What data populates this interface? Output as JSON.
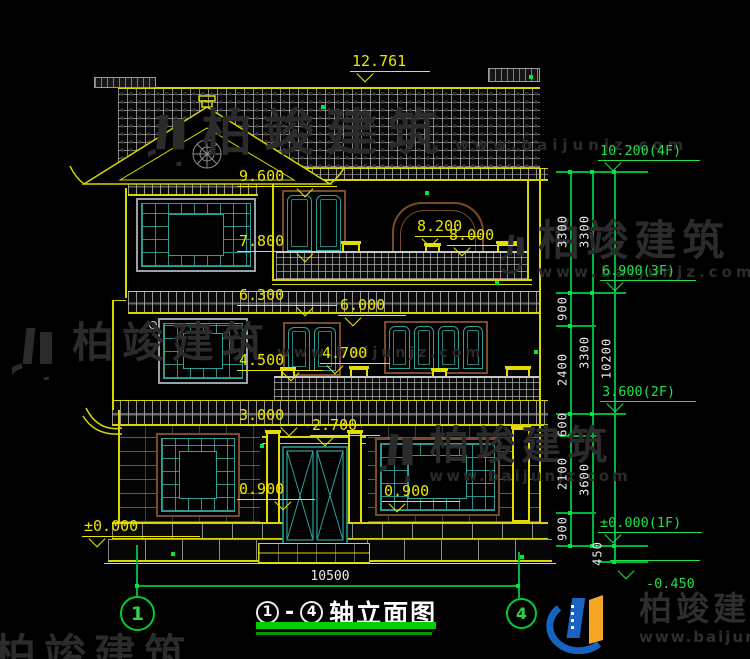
{
  "colors": {
    "background": "#000000",
    "dim_yellow": "#ece600",
    "axis_green": "#00cc33",
    "dim_text_white": "#ececec",
    "lattice_teal": "#2fa098",
    "frame_brown": "#7b4a2a",
    "frame_gray": "#98a2a8",
    "logo_blue": "#1464c0",
    "logo_orange": "#f5a623"
  },
  "title": {
    "axis_start": "1",
    "dash": "-",
    "axis_end": "4",
    "text": "轴立面图"
  },
  "axis_bubbles": {
    "left": "1",
    "right": "4"
  },
  "elevations": {
    "roof_peak": "12.761",
    "attic_canopy": "9.600",
    "attic_window": "7.800",
    "terrace_high": "8.200",
    "terrace_low": "8.000",
    "eave2_left": "6.300",
    "eave2_right": "6.000",
    "win2_left": "4.500",
    "win2_right": "4.700",
    "eave3_left": "3.000",
    "door_top": "2.700",
    "win1_left": "0.900",
    "win1_right": "0.900",
    "ground_left": "±0.000"
  },
  "floor_markers": {
    "f4": "10.200(4F)",
    "f3": "6.900(3F)",
    "f2": "3.600(2F)",
    "f1": "±0.000(1F)",
    "base": "-0.450"
  },
  "dimensions": {
    "overall_width": "10500",
    "col1": [
      "3300",
      "900",
      "2400",
      "600",
      "2100",
      "900"
    ],
    "col2": [
      "3300",
      "3300",
      "3600"
    ],
    "col3": [
      "10200"
    ],
    "foundation": "450"
  },
  "watermark": {
    "brand": "柏竣建筑",
    "url": "www.baijunjz.com"
  },
  "footer_logo": {
    "brand": "柏竣建筑",
    "url": "www.baijunjz.com"
  }
}
